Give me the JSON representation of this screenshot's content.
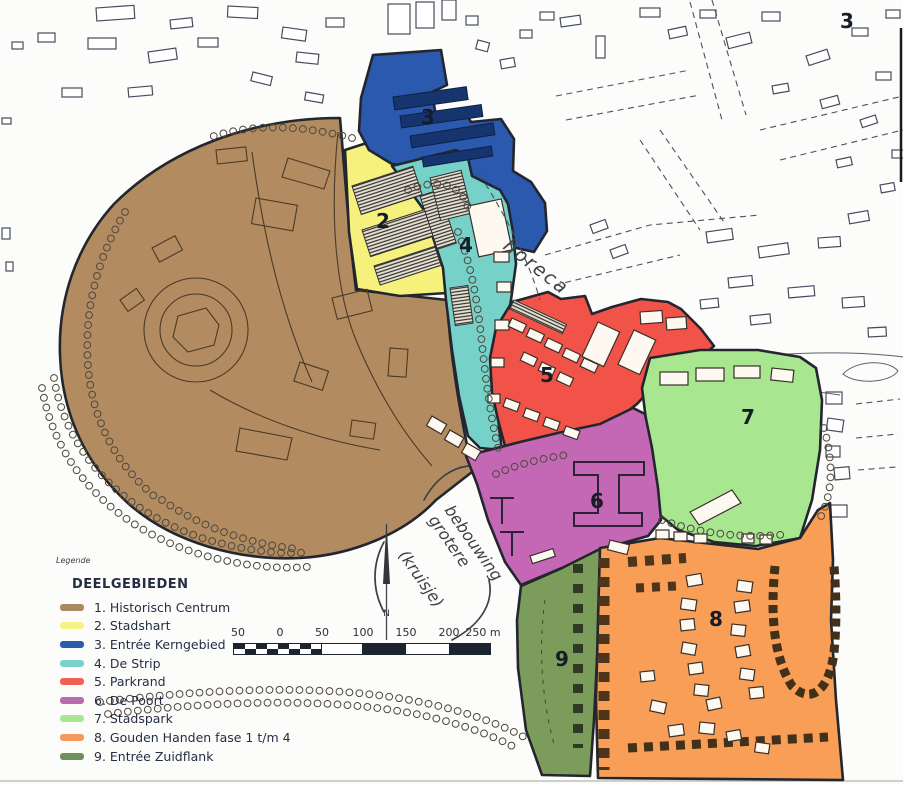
{
  "map": {
    "corner_label": "3",
    "zone_numbers": [
      "2",
      "3",
      "4",
      "5",
      "6",
      "7",
      "8",
      "9"
    ],
    "north_label": "N",
    "annotations": {
      "horeca": "horeca",
      "line1": "grotere",
      "line2": "bebouwing",
      "line3": "(kruisje)"
    }
  },
  "zones": {
    "z1": {
      "color": "#b28b61"
    },
    "z2": {
      "color": "#f6f07c"
    },
    "z3": {
      "color": "#2b59ae"
    },
    "z4": {
      "color": "#76d2c9"
    },
    "z5": {
      "color": "#f25348"
    },
    "z6": {
      "color": "#c468b6"
    },
    "z7": {
      "color": "#a8e690"
    },
    "z8": {
      "color": "#f89e57"
    },
    "z9": {
      "color": "#7b9c5a"
    }
  },
  "legend": {
    "caption": "Legende",
    "title": "DEELGEBIEDEN",
    "items": [
      {
        "label": "1. Historisch Centrum",
        "color": "#a98a63"
      },
      {
        "label": "2. Stadshart",
        "color": "#f6f287"
      },
      {
        "label": "3. Entrée Kerngebied",
        "color": "#2b5cab"
      },
      {
        "label": "4. De Strip",
        "color": "#79d1c9"
      },
      {
        "label": "5. Parkrand",
        "color": "#ef6156"
      },
      {
        "label": "6. De Poort",
        "color": "#ba6cb1"
      },
      {
        "label": "7. Stadspark",
        "color": "#a8e594"
      },
      {
        "label": "8. Gouden Handen fase 1 t/m 4",
        "color": "#f29a5d"
      },
      {
        "label": "9. Entrée Zuidflank",
        "color": "#6f905d"
      }
    ]
  },
  "scalebar": {
    "labels": [
      "50",
      "0",
      "50",
      "100",
      "150",
      "200",
      "250 m"
    ]
  }
}
